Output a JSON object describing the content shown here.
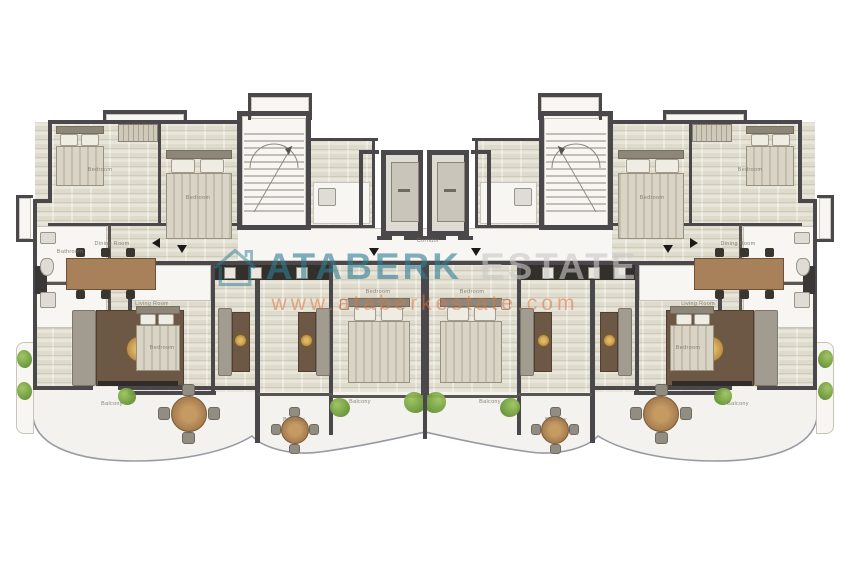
{
  "watermark": {
    "brand": "ATABERK",
    "suffix": "ESTATE",
    "url": "www.ataberkestate.com",
    "brand_color": "#2f7e95",
    "suffix_color": "#c9c9c9",
    "url_color": "#e0763f",
    "logo": "house-outline-icon"
  },
  "plan": {
    "type": "residential-floor-plan",
    "wall_color": "#4a484a",
    "floor_color": "#e7e3d6",
    "balcony_color": "#f3f2ee",
    "plant_color": "#6f9c3c",
    "labels": [
      {
        "text": "Bedroom",
        "x": 100,
        "y": 170
      },
      {
        "text": "Bedroom",
        "x": 198,
        "y": 198
      },
      {
        "text": "Bathroom",
        "x": 70,
        "y": 252
      },
      {
        "text": "Dining Room",
        "x": 112,
        "y": 244
      },
      {
        "text": "Living Room",
        "x": 152,
        "y": 304
      },
      {
        "text": "Bedroom",
        "x": 162,
        "y": 348
      },
      {
        "text": "Corridor",
        "x": 428,
        "y": 241
      },
      {
        "text": "Bedroom",
        "x": 378,
        "y": 292
      },
      {
        "text": "Bedroom",
        "x": 472,
        "y": 292
      },
      {
        "text": "Balcony",
        "x": 112,
        "y": 404
      },
      {
        "text": "Balcony",
        "x": 294,
        "y": 420
      },
      {
        "text": "Balcony",
        "x": 360,
        "y": 402
      },
      {
        "text": "Balcony",
        "x": 490,
        "y": 402
      },
      {
        "text": "Balcony",
        "x": 556,
        "y": 420
      },
      {
        "text": "Balcony",
        "x": 738,
        "y": 404
      },
      {
        "text": "Bedroom",
        "x": 652,
        "y": 198
      },
      {
        "text": "Bedroom",
        "x": 750,
        "y": 170
      },
      {
        "text": "Dining Room",
        "x": 738,
        "y": 244
      },
      {
        "text": "Living Room",
        "x": 698,
        "y": 304
      },
      {
        "text": "Bedroom",
        "x": 688,
        "y": 348
      }
    ]
  }
}
